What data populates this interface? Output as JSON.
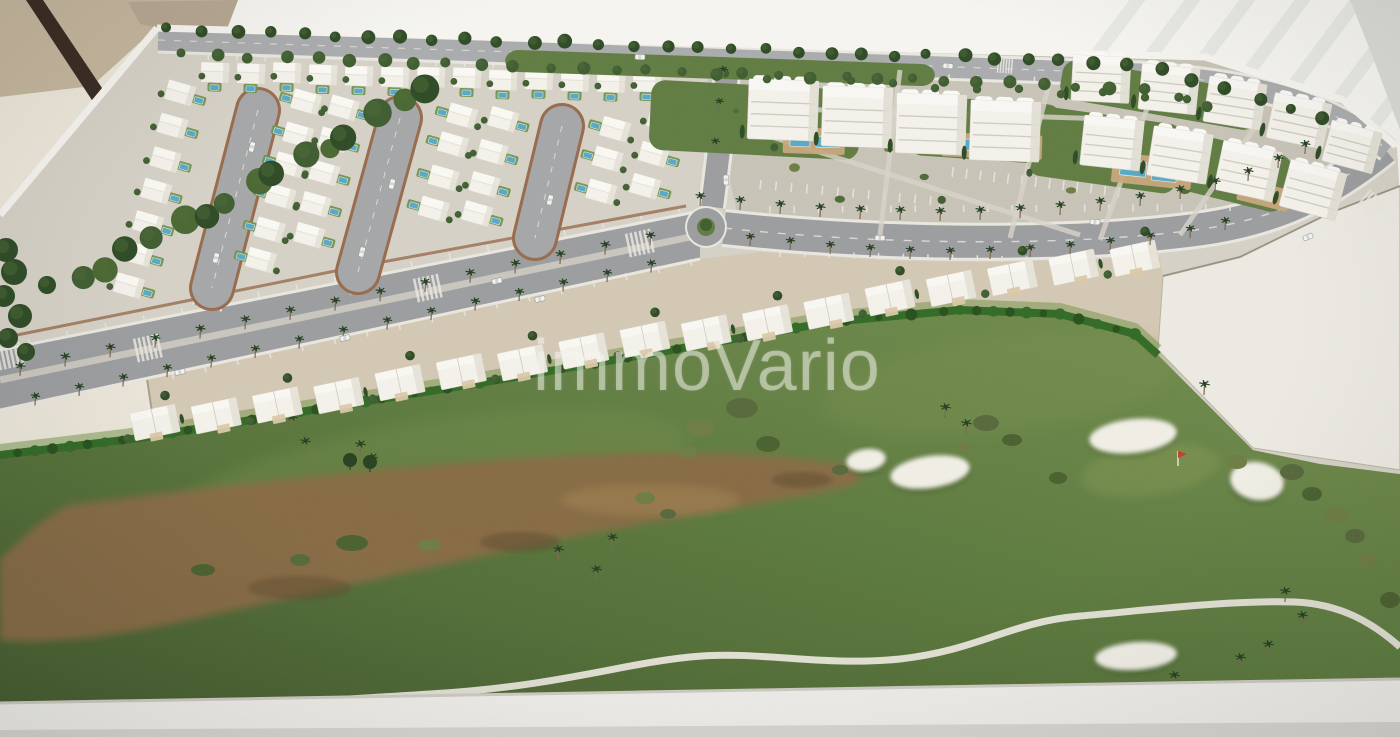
{
  "image": {
    "kind": "photograph",
    "subject": "architectural scale model (maquette) of a golf resort residential development, viewed at an angle on a white display base",
    "width_px": 1400,
    "height_px": 737
  },
  "watermark": {
    "text": "immoVario"
  },
  "scene": {
    "areas": [
      "villa district with three brick-edged loop streets, white villas and private pools",
      "white apartment blocks with communal pools, gardens and paths",
      "palm-lined boulevard with roundabout, crosswalks and parking bays",
      "row of white townhouses backed by a bright hedge",
      "golf course with sand bunkers, red pin flag, dry riverbed and winding cart path",
      "empty white future-phase plot",
      "tree-lined perimeter road along the top edge",
      "beige wall, dark stand rod and bright striped background around the model"
    ]
  },
  "colors": {
    "bg_right": "#f7f6f2",
    "stripe": "#e9e9e5",
    "wall_tan": "#c6b69c",
    "wall_dark": "#b0a18b",
    "rod": "#38291f",
    "bg_left": "#eee8da",
    "base": "#d7d2c6",
    "rim": "#f8f6f1",
    "plinth": "#f0efeb",
    "plinth_edge": "#cfccc4",
    "plinth_foot": "#c4c3bf",
    "road": "#9c9da0",
    "road_top": "#abacae",
    "marking": "#eae8e1",
    "brick": "#9a6a4a",
    "slab": "#ece7d9",
    "bldg": "#f5f3ec",
    "bldg_hi": "#fbfaf6",
    "bldg_shade": "#e1ddd1",
    "bldg_line": "#cfccc0",
    "pool": "#53abca",
    "deck": "#c9a87a",
    "lawn": "#6f9448",
    "garden": "#5f7d3f",
    "garden_dark": "#4c6a34",
    "plaza": "#c9c4b6",
    "tree_dark": "#2c4a23",
    "tree_mid": "#3d5c2e",
    "tree_light": "#4c6c33",
    "hedge": "#2f6b22",
    "hedge_hi": "#6d9040",
    "golf_hi": "#74904c",
    "golf_mid": "#5a7a3a",
    "golf_dark": "#445c2d",
    "bush": "#6d7c40",
    "bush_dark": "#556839",
    "river": "#8a6a42",
    "river_dark": "#5f4a2c",
    "river_hi": "#a5854f",
    "bunker": "#f2f0e6",
    "path": "#eae7db",
    "plot": "#edebe3",
    "plot_edge": "#83806f",
    "palm_trunk": "#7a6750",
    "palm_head": "#22401f",
    "car": "#f4f4f0",
    "car_shadow": "#8e8f91",
    "flag": "#c93b2a",
    "pole": "#e8e8e8"
  }
}
